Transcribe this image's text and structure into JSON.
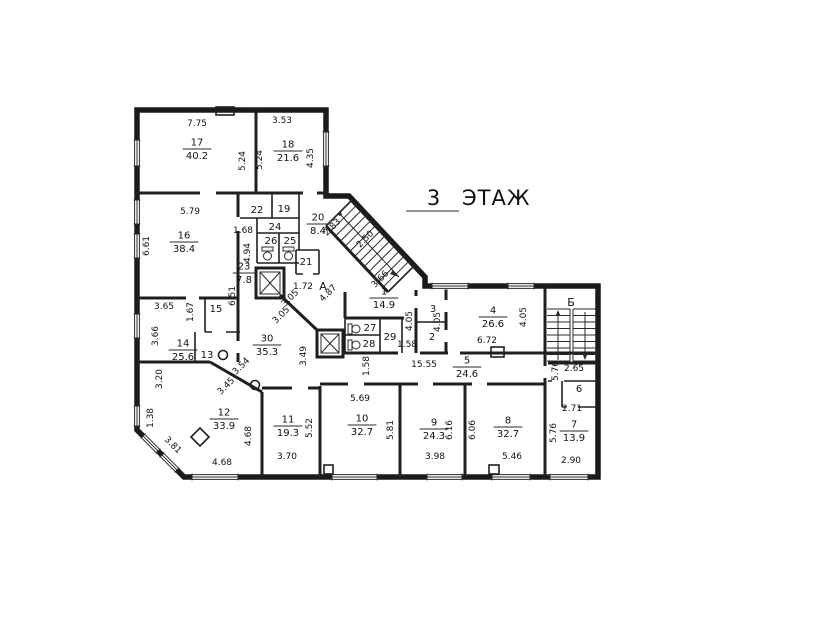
{
  "title": {
    "floor_number": "3",
    "floor_word": "ЭТАЖ"
  },
  "axes": [
    {
      "label": "А",
      "x": 323,
      "y": 290
    },
    {
      "label": "Б",
      "x": 571,
      "y": 306
    }
  ],
  "rooms": [
    {
      "num": "17",
      "area": "40.2",
      "x": 197,
      "y": 148
    },
    {
      "num": "18",
      "area": "21.6",
      "x": 288,
      "y": 150
    },
    {
      "num": "16",
      "area": "38.4",
      "x": 184,
      "y": 241
    },
    {
      "num": "20",
      "area": "8.4",
      "x": 318,
      "y": 223
    },
    {
      "num": "23",
      "area": "7.8",
      "x": 244,
      "y": 272
    },
    {
      "num": "14",
      "area": "25.6",
      "x": 183,
      "y": 349
    },
    {
      "num": "30",
      "area": "35.3",
      "x": 267,
      "y": 344
    },
    {
      "num": "1",
      "area": "14.9",
      "x": 384,
      "y": 297
    },
    {
      "num": "4",
      "area": "26.6",
      "x": 493,
      "y": 316
    },
    {
      "num": "5",
      "area": "24.6",
      "x": 467,
      "y": 366
    },
    {
      "num": "12",
      "area": "33.9",
      "x": 224,
      "y": 418
    },
    {
      "num": "11",
      "area": "19.3",
      "x": 288,
      "y": 425
    },
    {
      "num": "10",
      "area": "32.7",
      "x": 362,
      "y": 424
    },
    {
      "num": "9",
      "area": "24.3",
      "x": 434,
      "y": 428
    },
    {
      "num": "8",
      "area": "32.7",
      "x": 508,
      "y": 426
    },
    {
      "num": "7",
      "area": "13.9",
      "x": 574,
      "y": 430
    }
  ],
  "small_rooms": [
    {
      "num": "22",
      "x": 257,
      "y": 213
    },
    {
      "num": "19",
      "x": 284,
      "y": 212
    },
    {
      "num": "24",
      "x": 275,
      "y": 230
    },
    {
      "num": "26",
      "x": 271,
      "y": 244
    },
    {
      "num": "25",
      "x": 290,
      "y": 244
    },
    {
      "num": "21",
      "x": 306,
      "y": 265
    },
    {
      "num": "15",
      "x": 216,
      "y": 312
    },
    {
      "num": "13",
      "x": 207,
      "y": 358
    },
    {
      "num": "3",
      "x": 433,
      "y": 312
    },
    {
      "num": "2",
      "x": 432,
      "y": 340
    },
    {
      "num": "27",
      "x": 370,
      "y": 331
    },
    {
      "num": "28",
      "x": 369,
      "y": 347
    },
    {
      "num": "29",
      "x": 390,
      "y": 340
    },
    {
      "num": "6",
      "x": 579,
      "y": 392
    }
  ],
  "dimensions": [
    {
      "text": "7.75",
      "x": 197,
      "y": 126,
      "rot": 0
    },
    {
      "text": "3.53",
      "x": 282,
      "y": 123,
      "rot": 0
    },
    {
      "text": "5.24",
      "x": 245,
      "y": 161,
      "rot": -90
    },
    {
      "text": "5.24",
      "x": 262,
      "y": 160,
      "rot": -90
    },
    {
      "text": "4.35",
      "x": 313,
      "y": 158,
      "rot": -90
    },
    {
      "text": "5.79",
      "x": 190,
      "y": 214,
      "rot": 0
    },
    {
      "text": "6.61",
      "x": 149,
      "y": 246,
      "rot": -90
    },
    {
      "text": "1.68",
      "x": 243,
      "y": 233,
      "rot": 0
    },
    {
      "text": "4.94",
      "x": 250,
      "y": 253,
      "rot": -90
    },
    {
      "text": "6.51",
      "x": 235,
      "y": 296,
      "rot": -90
    },
    {
      "text": "2.83",
      "x": 334,
      "y": 229,
      "rot": -45
    },
    {
      "text": "2.50",
      "x": 367,
      "y": 241,
      "rot": -45
    },
    {
      "text": "4.87",
      "x": 330,
      "y": 295,
      "rot": -45
    },
    {
      "text": "3.05",
      "x": 292,
      "y": 300,
      "rot": -45
    },
    {
      "text": "3.05",
      "x": 283,
      "y": 317,
      "rot": -45
    },
    {
      "text": "1.72",
      "x": 303,
      "y": 289,
      "rot": 0
    },
    {
      "text": "3.66",
      "x": 382,
      "y": 281,
      "rot": -45
    },
    {
      "text": "3.49",
      "x": 306,
      "y": 356,
      "rot": -90
    },
    {
      "text": "3.54",
      "x": 243,
      "y": 368,
      "rot": -45
    },
    {
      "text": "3.45",
      "x": 228,
      "y": 388,
      "rot": -45
    },
    {
      "text": "3.65",
      "x": 164,
      "y": 309,
      "rot": 0
    },
    {
      "text": "1.67",
      "x": 193,
      "y": 312,
      "rot": -90
    },
    {
      "text": "3.66",
      "x": 158,
      "y": 336,
      "rot": -90
    },
    {
      "text": "3.20",
      "x": 162,
      "y": 379,
      "rot": -90
    },
    {
      "text": "1.38",
      "x": 153,
      "y": 418,
      "rot": -90
    },
    {
      "text": "3.81",
      "x": 171,
      "y": 447,
      "rot": 45
    },
    {
      "text": "4.68",
      "x": 222,
      "y": 465,
      "rot": 0
    },
    {
      "text": "4.68",
      "x": 251,
      "y": 436,
      "rot": -90
    },
    {
      "text": "3.70",
      "x": 287,
      "y": 459,
      "rot": 0
    },
    {
      "text": "5.52",
      "x": 312,
      "y": 428,
      "rot": -90
    },
    {
      "text": "5.69",
      "x": 360,
      "y": 401,
      "rot": 0
    },
    {
      "text": "5.81",
      "x": 393,
      "y": 430,
      "rot": -90
    },
    {
      "text": "1.58",
      "x": 369,
      "y": 366,
      "rot": -90
    },
    {
      "text": "15.55",
      "x": 424,
      "y": 367,
      "rot": 0
    },
    {
      "text": "1.58",
      "x": 407,
      "y": 347,
      "rot": 0
    },
    {
      "text": "4.05",
      "x": 412,
      "y": 321,
      "rot": -90
    },
    {
      "text": "4.05",
      "x": 440,
      "y": 322,
      "rot": -90
    },
    {
      "text": "4.05",
      "x": 526,
      "y": 317,
      "rot": -90
    },
    {
      "text": "6.72",
      "x": 487,
      "y": 343,
      "rot": 0
    },
    {
      "text": "6.16",
      "x": 452,
      "y": 430,
      "rot": -90
    },
    {
      "text": "6.06",
      "x": 475,
      "y": 430,
      "rot": -90
    },
    {
      "text": "3.98",
      "x": 435,
      "y": 459,
      "rot": 0
    },
    {
      "text": "5.46",
      "x": 512,
      "y": 459,
      "rot": 0
    },
    {
      "text": "5.76",
      "x": 558,
      "y": 371,
      "rot": -90
    },
    {
      "text": "2.65",
      "x": 574,
      "y": 371,
      "rot": 0
    },
    {
      "text": "2.71",
      "x": 572,
      "y": 411,
      "rot": 0
    },
    {
      "text": "5.76",
      "x": 556,
      "y": 433,
      "rot": -90
    },
    {
      "text": "2.90",
      "x": 571,
      "y": 463,
      "rot": 0
    }
  ]
}
